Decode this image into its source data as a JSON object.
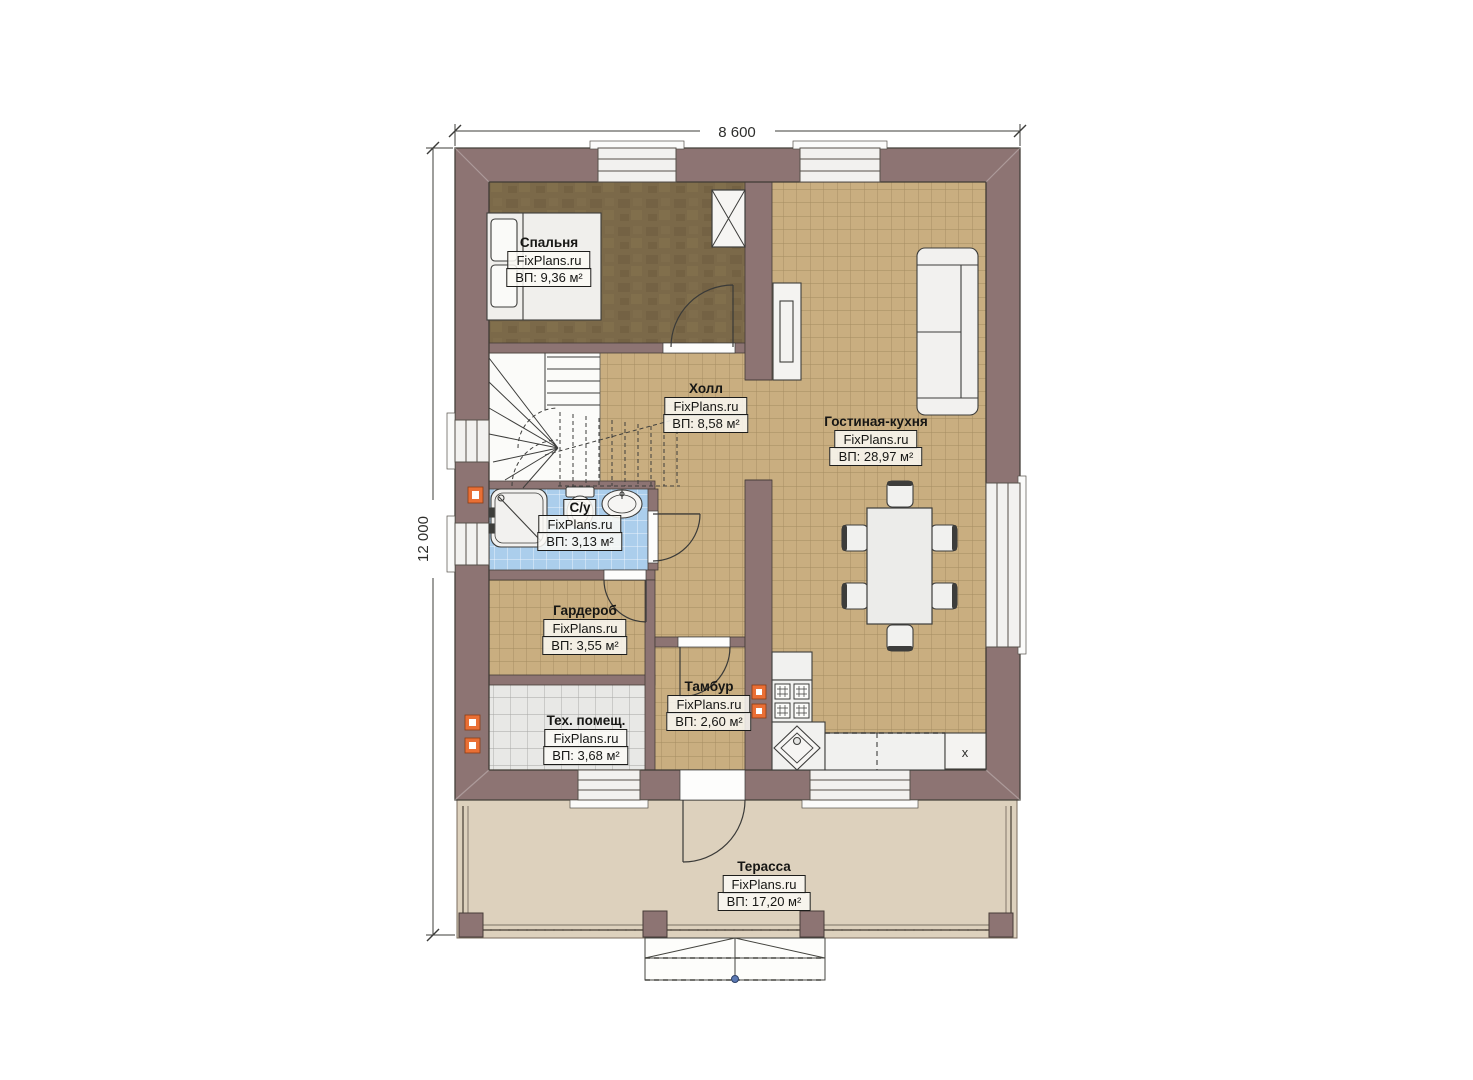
{
  "title": "План 1-го этажа",
  "dimensions": {
    "width_label": "8 600",
    "height_label": "12 000"
  },
  "rooms": [
    {
      "id": "bedroom",
      "name": "Спальня",
      "brand": "FixPlans.ru",
      "area": "ВП: 9,36 м²"
    },
    {
      "id": "hall",
      "name": "Холл",
      "brand": "FixPlans.ru",
      "area": "ВП: 8,58 м²"
    },
    {
      "id": "living-kitchen",
      "name": "Гостиная-кухня",
      "brand": "FixPlans.ru",
      "area": "ВП: 28,97 м²"
    },
    {
      "id": "bathroom",
      "name": "С/у",
      "brand": "FixPlans.ru",
      "area": "ВП: 3,13 м²"
    },
    {
      "id": "wardrobe",
      "name": "Гардероб",
      "brand": "FixPlans.ru",
      "area": "ВП: 3,55 м²"
    },
    {
      "id": "tambour",
      "name": "Тамбур",
      "brand": "FixPlans.ru",
      "area": "ВП: 2,60 м²"
    },
    {
      "id": "tech-room",
      "name": "Тех. помещ.",
      "brand": "FixPlans.ru",
      "area": "ВП: 3,68 м²"
    },
    {
      "id": "terrace",
      "name": "Терасса",
      "brand": "FixPlans.ru",
      "area": "ВП: 17,20 м²"
    }
  ],
  "kitchen": {
    "fridge_label": "x"
  },
  "colors": {
    "wall": "#8d7473",
    "floor_tile_tan": "#c9ae80",
    "floor_bedroom": "#7b6949",
    "floor_bathroom": "#abceec",
    "floor_tech": "#e8e8e6",
    "terrace": "#ddd1bd",
    "vent_marker": "#e96f35",
    "stairs_dot": "#5b79b4"
  }
}
